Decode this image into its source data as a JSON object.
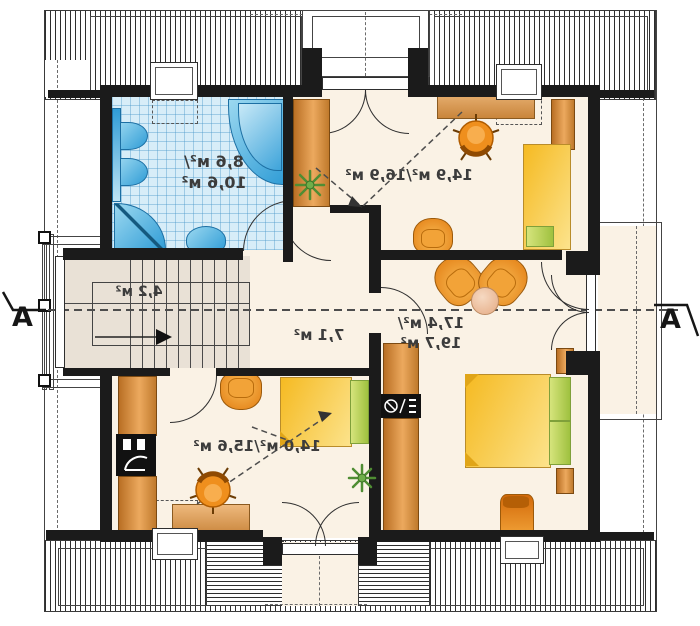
{
  "plan": {
    "section_marker": "A",
    "rooms": {
      "bathroom": {
        "area_line1": "8,6 м²/",
        "area_line2": "10,6 м²"
      },
      "bedroom_upper": {
        "area_label": "14,9 м²/16,9 м²"
      },
      "staircase": {
        "area_label": "4,2 м²"
      },
      "hall": {
        "area_label": "7,1 м²"
      },
      "bedroom_lower_left": {
        "area_label": "14,0 м²/15,6 м²"
      },
      "master_bedroom": {
        "area_line1": "17,4 м²/",
        "area_line2": "19,7 м²"
      }
    },
    "colors": {
      "wall": "#1b1b1b",
      "floor": "#faf2e5",
      "bath_tile": "#d7edf8",
      "fixture_blue": "#4aaede",
      "furniture_orange": "#ef9330",
      "bed_yellow": "#f8c62f",
      "pillow_green": "#c2d765",
      "stair_grey": "#e9e1d6"
    }
  }
}
